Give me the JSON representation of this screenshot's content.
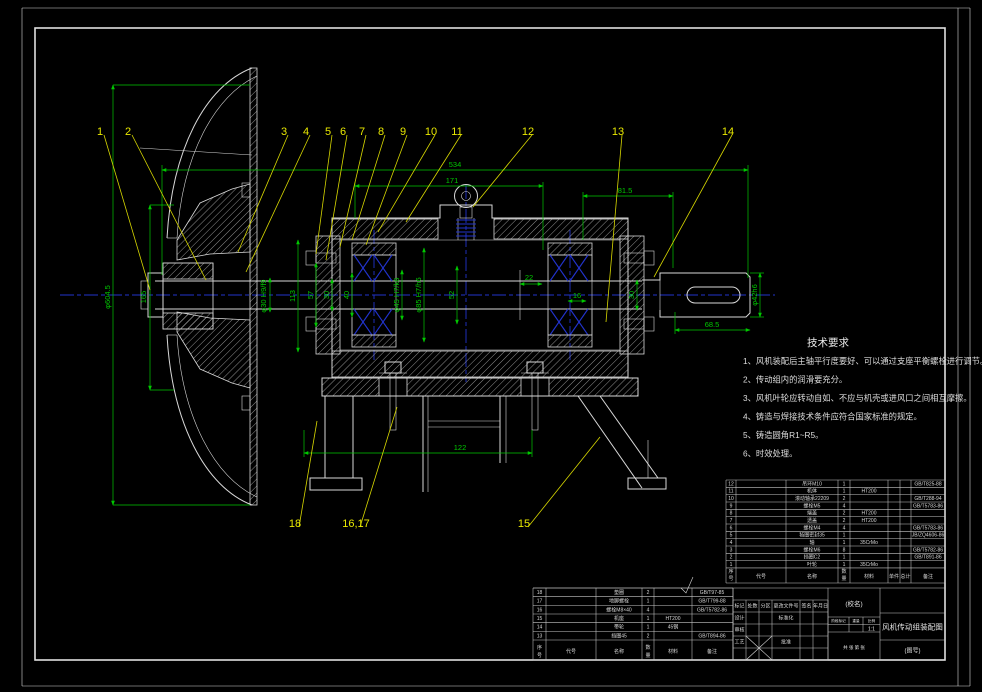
{
  "colors": {
    "background": "#000000",
    "geometry": "#d9d9d9",
    "dimension_green": "#00c800",
    "callout_yellow": "#e8e800",
    "centerline_blue": "#2233cc"
  },
  "tech_requirements": {
    "title": "技术要求",
    "items": [
      "1、风机装配后主轴平行度要好、可以通过支座平衡螺栓进行调节。",
      "2、传动组内的润滑要充分。",
      "3、风机叶轮应转动自如、不应与机壳或进风口之间相互摩擦。",
      "4、铸造与焊接技术条件应符合国家标准的规定。",
      "5、铸造圆角R1~R5。",
      "6、时效处理。"
    ]
  },
  "callouts": [
    {
      "label": "1",
      "x": 100,
      "y": 131,
      "tx": 150,
      "ty": 290
    },
    {
      "label": "2",
      "x": 128,
      "y": 131,
      "tx": 206,
      "ty": 280
    },
    {
      "label": "3",
      "x": 284,
      "y": 131,
      "tx": 238,
      "ty": 252
    },
    {
      "label": "4",
      "x": 306,
      "y": 131,
      "tx": 246,
      "ty": 272
    },
    {
      "label": "5",
      "x": 328,
      "y": 131,
      "tx": 316,
      "ty": 254
    },
    {
      "label": "6",
      "x": 343,
      "y": 131,
      "tx": 326,
      "ty": 260
    },
    {
      "label": "7",
      "x": 362,
      "y": 131,
      "tx": 340,
      "ty": 247
    },
    {
      "label": "8",
      "x": 381,
      "y": 131,
      "tx": 352,
      "ty": 240
    },
    {
      "label": "9",
      "x": 403,
      "y": 131,
      "tx": 366,
      "ty": 245
    },
    {
      "label": "10",
      "x": 431,
      "y": 131,
      "tx": 378,
      "ty": 232
    },
    {
      "label": "11",
      "x": 457,
      "y": 131,
      "tx": 406,
      "ty": 222
    },
    {
      "label": "12",
      "x": 528,
      "y": 131,
      "tx": 473,
      "ty": 207
    },
    {
      "label": "13",
      "x": 618,
      "y": 131,
      "tx": 606,
      "ty": 322
    },
    {
      "label": "14",
      "x": 728,
      "y": 131,
      "tx": 654,
      "ty": 277
    },
    {
      "label": "15",
      "x": 524,
      "y": 523,
      "tx": 600,
      "ty": 437
    },
    {
      "label": "16,17",
      "x": 356,
      "y": 523,
      "tx": 397,
      "ty": 407
    },
    {
      "label": "18",
      "x": 295,
      "y": 523,
      "tx": 317,
      "ty": 421
    }
  ],
  "dim_labels": [
    {
      "text": "534",
      "x": 455,
      "y": 167,
      "rot": false
    },
    {
      "text": "171",
      "x": 452,
      "y": 183,
      "rot": false
    },
    {
      "text": "81.5",
      "x": 625,
      "y": 193,
      "rot": false
    },
    {
      "text": "165",
      "x": 146,
      "y": 297,
      "rot": true
    },
    {
      "text": "φ604.5",
      "x": 110,
      "y": 297,
      "rot": true
    },
    {
      "text": "φ30 H9/f9",
      "x": 266,
      "y": 296,
      "rot": true
    },
    {
      "text": "113",
      "x": 295,
      "y": 296,
      "rot": true
    },
    {
      "text": "57",
      "x": 313,
      "y": 295,
      "rot": true
    },
    {
      "text": "30",
      "x": 329,
      "y": 295,
      "rot": true
    },
    {
      "text": "40",
      "x": 349,
      "y": 295,
      "rot": true
    },
    {
      "text": "φ45 H7/k6",
      "x": 399,
      "y": 295,
      "rot": true
    },
    {
      "text": "φ85 H7/h6",
      "x": 421,
      "y": 295,
      "rot": true
    },
    {
      "text": "52",
      "x": 454,
      "y": 295,
      "rot": true
    },
    {
      "text": "22",
      "x": 529,
      "y": 280,
      "rot": false
    },
    {
      "text": "16",
      "x": 577,
      "y": 298,
      "rot": false
    },
    {
      "text": "30",
      "x": 634,
      "y": 295,
      "rot": true
    },
    {
      "text": "φ42h6",
      "x": 757,
      "y": 295,
      "rot": true
    },
    {
      "text": "68.5",
      "x": 712,
      "y": 327,
      "rot": false
    },
    {
      "text": "122",
      "x": 460,
      "y": 450,
      "rot": false
    }
  ],
  "bom_headers": {
    "no": "序号",
    "code": "代号",
    "name": "名称",
    "qty": "数量",
    "material": "材料",
    "unit": "单件",
    "total": "总计",
    "remark": "备注"
  },
  "bom_upper": {
    "rows": [
      {
        "no": "12",
        "name": "吊环M10",
        "qty": "1",
        "material": "",
        "std": "GB/T825-88"
      },
      {
        "no": "11",
        "name": "机体",
        "qty": "1",
        "material": "HT200",
        "std": ""
      },
      {
        "no": "10",
        "name": "滚动轴承22209",
        "qty": "2",
        "material": "",
        "std": "GB/T288-94"
      },
      {
        "no": "9",
        "name": "螺栓M5",
        "qty": "4",
        "material": "",
        "std": "GB/T5783-86"
      },
      {
        "no": "8",
        "name": "端盖",
        "qty": "2",
        "material": "HT200",
        "std": ""
      },
      {
        "no": "7",
        "name": "透盖",
        "qty": "2",
        "material": "HT200",
        "std": ""
      },
      {
        "no": "6",
        "name": "螺栓M4",
        "qty": "4",
        "material": "",
        "std": "GB/T5783-86"
      },
      {
        "no": "5",
        "name": "毡圈密封35",
        "qty": "1",
        "material": "",
        "std": "JB/ZQ4606-86"
      },
      {
        "no": "4",
        "name": "轴",
        "qty": "1",
        "material": "35CrMo",
        "std": ""
      },
      {
        "no": "3",
        "name": "螺栓M6",
        "qty": "8",
        "material": "",
        "std": "GB/T5782-86"
      },
      {
        "no": "2",
        "name": "挡圈C2",
        "qty": "1",
        "material": "",
        "std": "GB/T891-86"
      },
      {
        "no": "1",
        "name": "叶轮",
        "qty": "1",
        "material": "35CrMo",
        "std": ""
      }
    ]
  },
  "bom_lower": {
    "rows": [
      {
        "no": "18",
        "name": "垫圈",
        "qty": "2",
        "material": "",
        "std": "GB/T97-85"
      },
      {
        "no": "17",
        "name": "地脚螺栓",
        "qty": "1",
        "material": "",
        "std": "GB/T799-88"
      },
      {
        "no": "16",
        "name": "螺栓M8×40",
        "qty": "4",
        "material": "",
        "std": "GB/T5782-86"
      },
      {
        "no": "15",
        "name": "机座",
        "qty": "1",
        "material": "HT200",
        "std": ""
      },
      {
        "no": "14",
        "name": "带轮",
        "qty": "1",
        "material": "45钢",
        "std": ""
      },
      {
        "no": "13",
        "name": "挡圈45",
        "qty": "2",
        "material": "",
        "std": "GB/T894-86"
      }
    ]
  },
  "titleblock": {
    "rev_headers": [
      "标记",
      "处数",
      "分区",
      "更改文件号",
      "签名",
      "年月日"
    ],
    "left_roles": [
      [
        "设计",
        "标准化"
      ],
      [
        "审核",
        ""
      ],
      [
        "工艺",
        "批准"
      ]
    ],
    "stage_label": "阶段标记",
    "weight_label": "重量",
    "scale_label": "比例",
    "scale": "1:1",
    "sheet_note": "共 张 第 张",
    "org": "(校名)",
    "title": "风机传动组装配图",
    "code": "(图号)"
  }
}
